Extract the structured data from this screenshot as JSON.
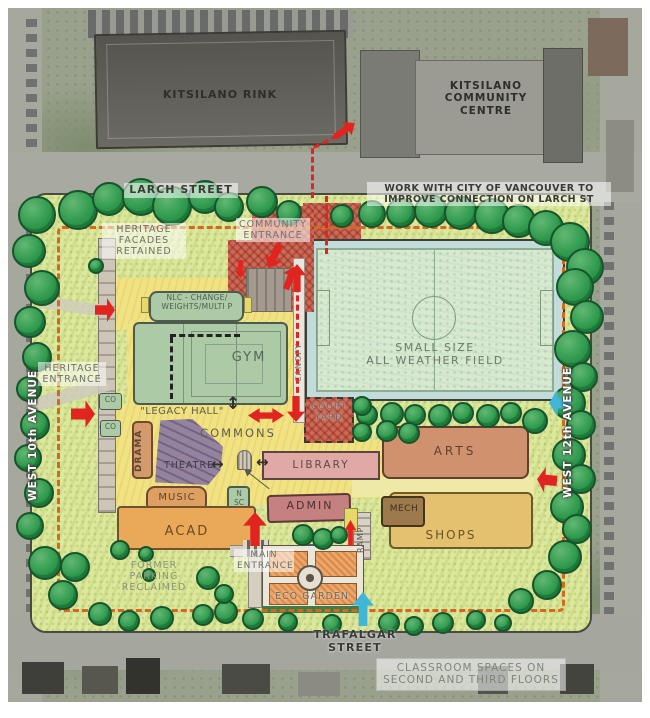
{
  "context": {
    "rink_label": "KITSILANO RINK",
    "community_centre_lines": [
      "KITSILANO",
      "COMMUNITY",
      "CENTRE"
    ]
  },
  "streets": {
    "larch": "LARCH STREET",
    "trafalgar": "TRAFALGAR STREET",
    "west_10th": "WEST 10th AVENUE",
    "west_12th": "WEST 12th AVENUE"
  },
  "notes": {
    "larch_note_lines": [
      "WORK WITH CITY OF VANCOUVER TO",
      "IMPROVE CONNECTION ON LARCH ST"
    ],
    "classroom_note_lines": [
      "CLASSROOM SPACES ON",
      "SECOND AND THIRD FLOORS"
    ],
    "heritage_facades_lines": [
      "HERITAGE",
      "FACADES",
      "RETAINED"
    ],
    "former_parking_lines": [
      "FORMER",
      "PARKING",
      "RECLAIMED"
    ]
  },
  "entrances": {
    "community_lines": [
      "COMMUNITY",
      "ENTRANCE"
    ],
    "heritage_lines": [
      "HERITAGE",
      "ENTRANCE"
    ],
    "main_lines": [
      "MAIN",
      "ENTRANCE"
    ]
  },
  "plan": {
    "nlc_lines": [
      "NLC - CHANGE/",
      "WEIGHTS/MULTI P"
    ],
    "gym": "GYM",
    "field_lines": [
      "SMALL SIZE",
      "ALL WEATHER FIELD"
    ],
    "legacy_hall": "\"LEGACY HALL\"",
    "commons": "COMMONS",
    "drama": "DRAMA",
    "theatre": "THEATRE",
    "courtyard_lines": [
      "COURT",
      "YARD"
    ],
    "library": "LIBRARY",
    "arts": "ARTS",
    "canopy": "CANOPY",
    "music": "MUSIC",
    "nsc_lines": [
      "N",
      "SC"
    ],
    "admin": "ADMIN",
    "acad": "ACAD",
    "mech": "MECH",
    "shops": "SHOPS",
    "ramp": "RAMP",
    "eco_garden": "ECO GARDEN",
    "co_upper": "CO",
    "co_lower": "CO"
  },
  "colors": {
    "property_line": "#d2691e",
    "red_arrow": "#e02521",
    "blue_arrow": "#41b6d9",
    "tree_green": "#2f9a4e",
    "commons_yellow": "#f1e283",
    "gym_green": "#abcaa5",
    "field_green": "#d8e9cf",
    "library_pink": "#e0a9a5",
    "arts_terracotta": "#d0916e",
    "shops_tan": "#e4c16e",
    "admin_pink": "#c58080",
    "theatre_purple": "#94839e",
    "entrance_red": "#cb6a57"
  }
}
